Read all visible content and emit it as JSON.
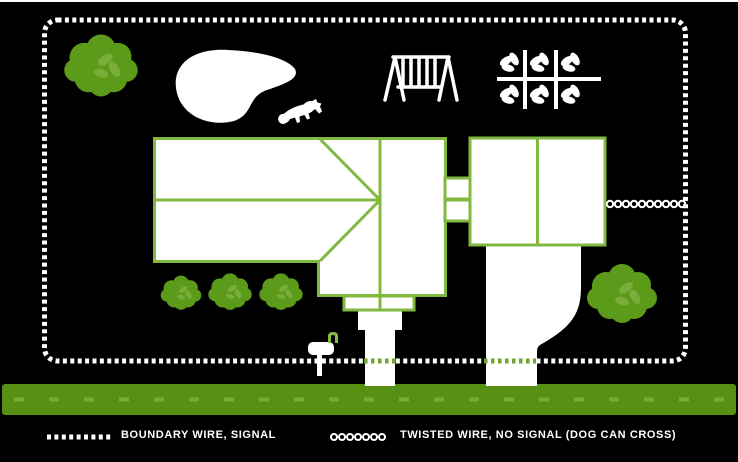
{
  "legend": {
    "boundary_wire": {
      "swatch": "dashed-line",
      "label": "BOUNDARY WIRE, SIGNAL"
    },
    "twisted_wire": {
      "swatch": "circle-line",
      "label": "TWISTED WIRE, NO SIGNAL (DOG CAN CROSS)"
    }
  },
  "icons": {
    "bush": "bush-icon",
    "dog": "dog-icon",
    "swing_set": "swing-set-icon",
    "garden": "garden-grid-icon",
    "mailbox": "mailbox-icon",
    "pond": "pond-shape",
    "house": "house-footprint",
    "garage": "garage-footprint"
  },
  "colors": {
    "background": "#000000",
    "wire": "#ffffff",
    "white_fill": "#ffffff",
    "house_outline": "#80b840",
    "bush": "#5c9a1a",
    "bush_leaf": "#79ad3c",
    "road": "#569113",
    "road_dash": "#79a93b",
    "cross_dash": "#6fa52c",
    "mailbox_flag": "#85bb3f"
  }
}
